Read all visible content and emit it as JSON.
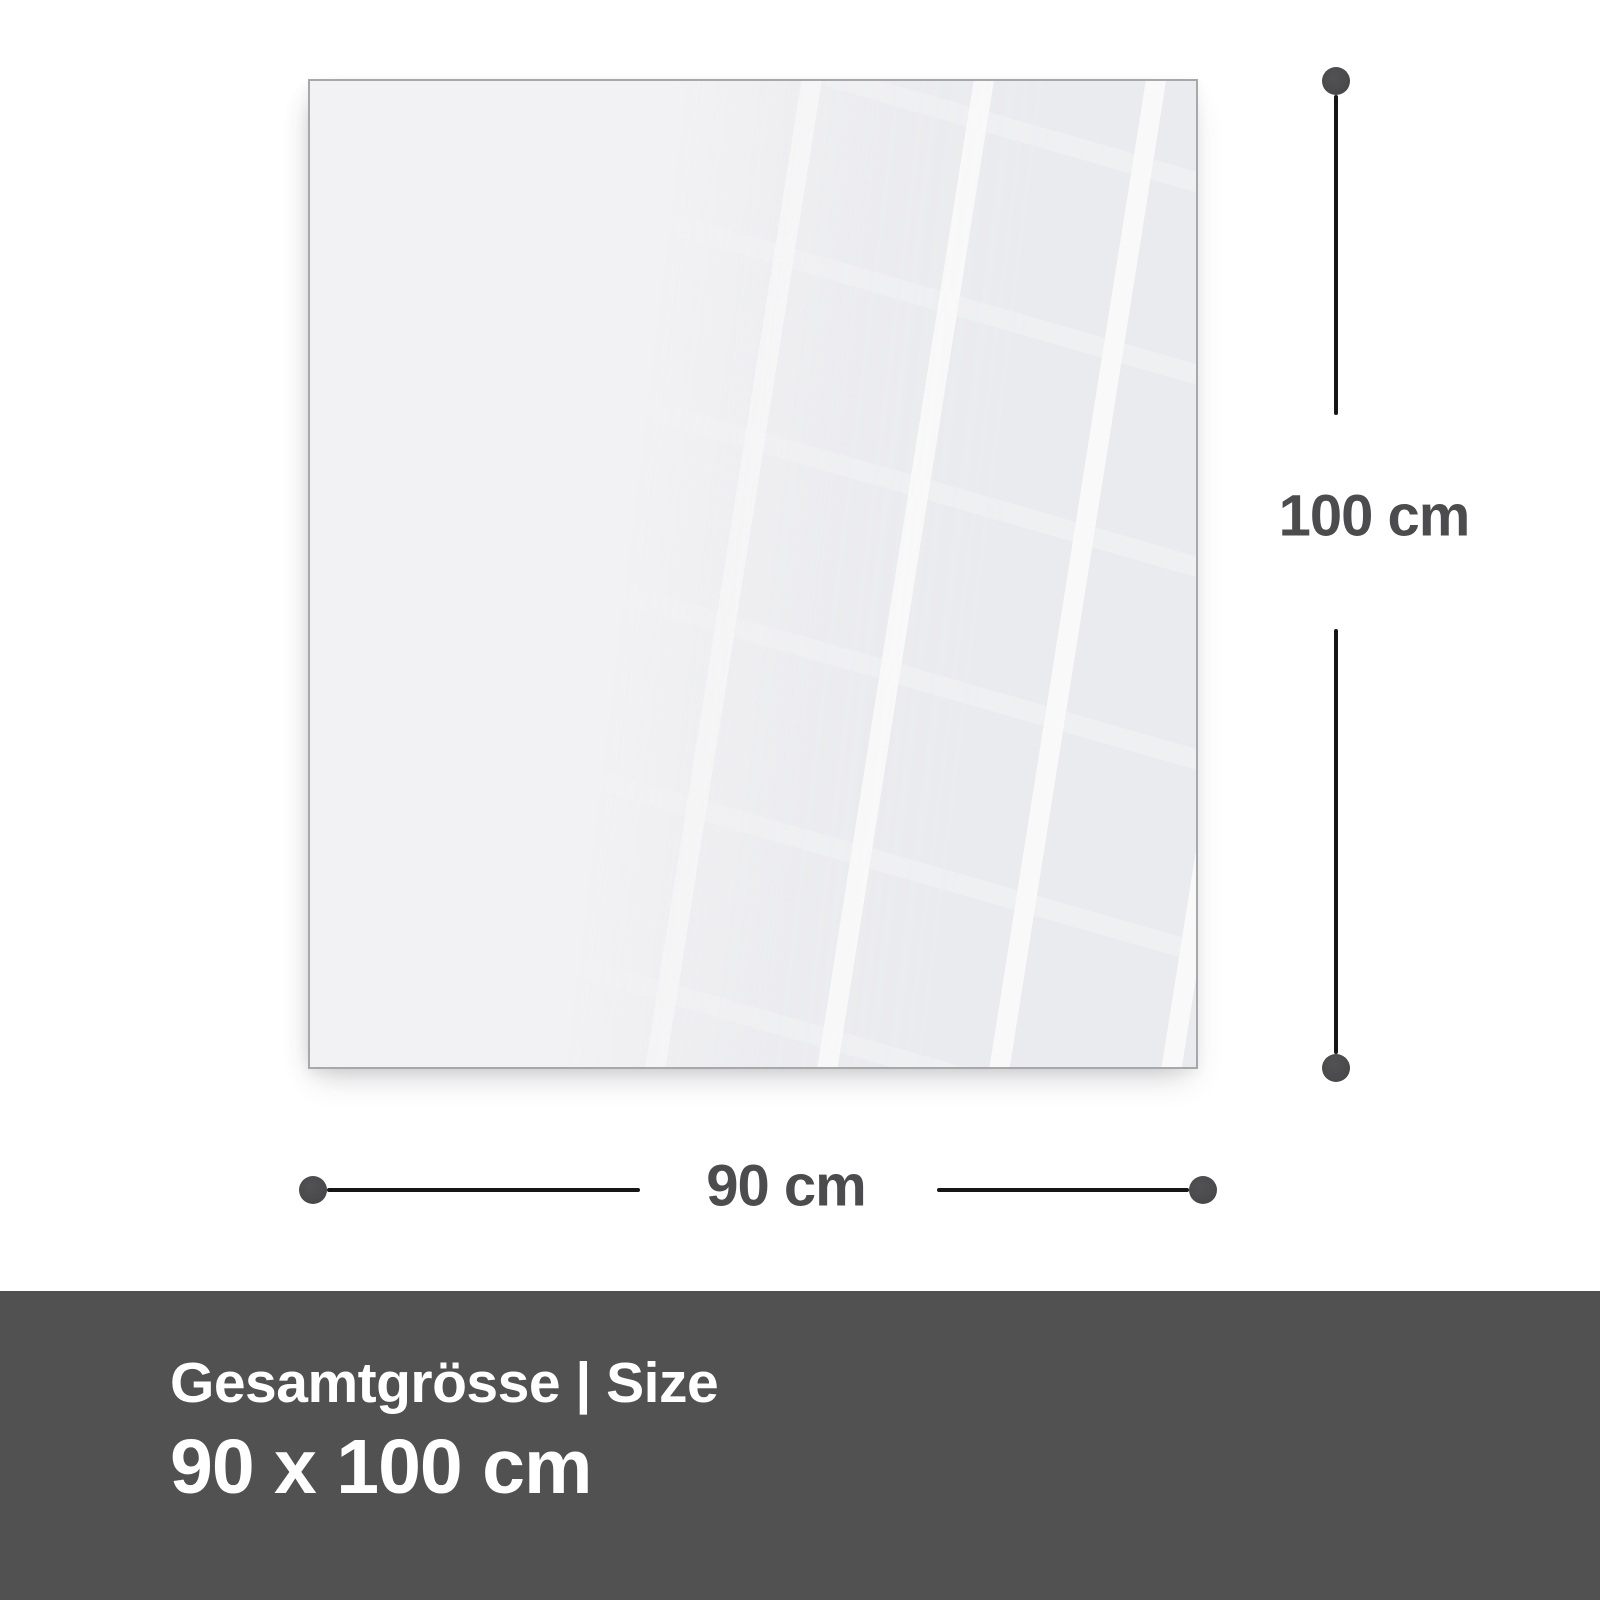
{
  "diagram": {
    "height_label": "100 cm",
    "width_label": "90 cm"
  },
  "banner": {
    "caption": "Gesamtgrösse | Size",
    "size_value": "90 x 100 cm"
  },
  "colors": {
    "page_bg": "#ffffff",
    "panel_fill": "#f2f2f4",
    "panel_border": "#a6a8aa",
    "line_color": "#161617",
    "dot_color": "#4a4a4c",
    "dim_text": "#4c4c4e",
    "banner_bg": "#515152",
    "banner_text": "#ffffff"
  }
}
